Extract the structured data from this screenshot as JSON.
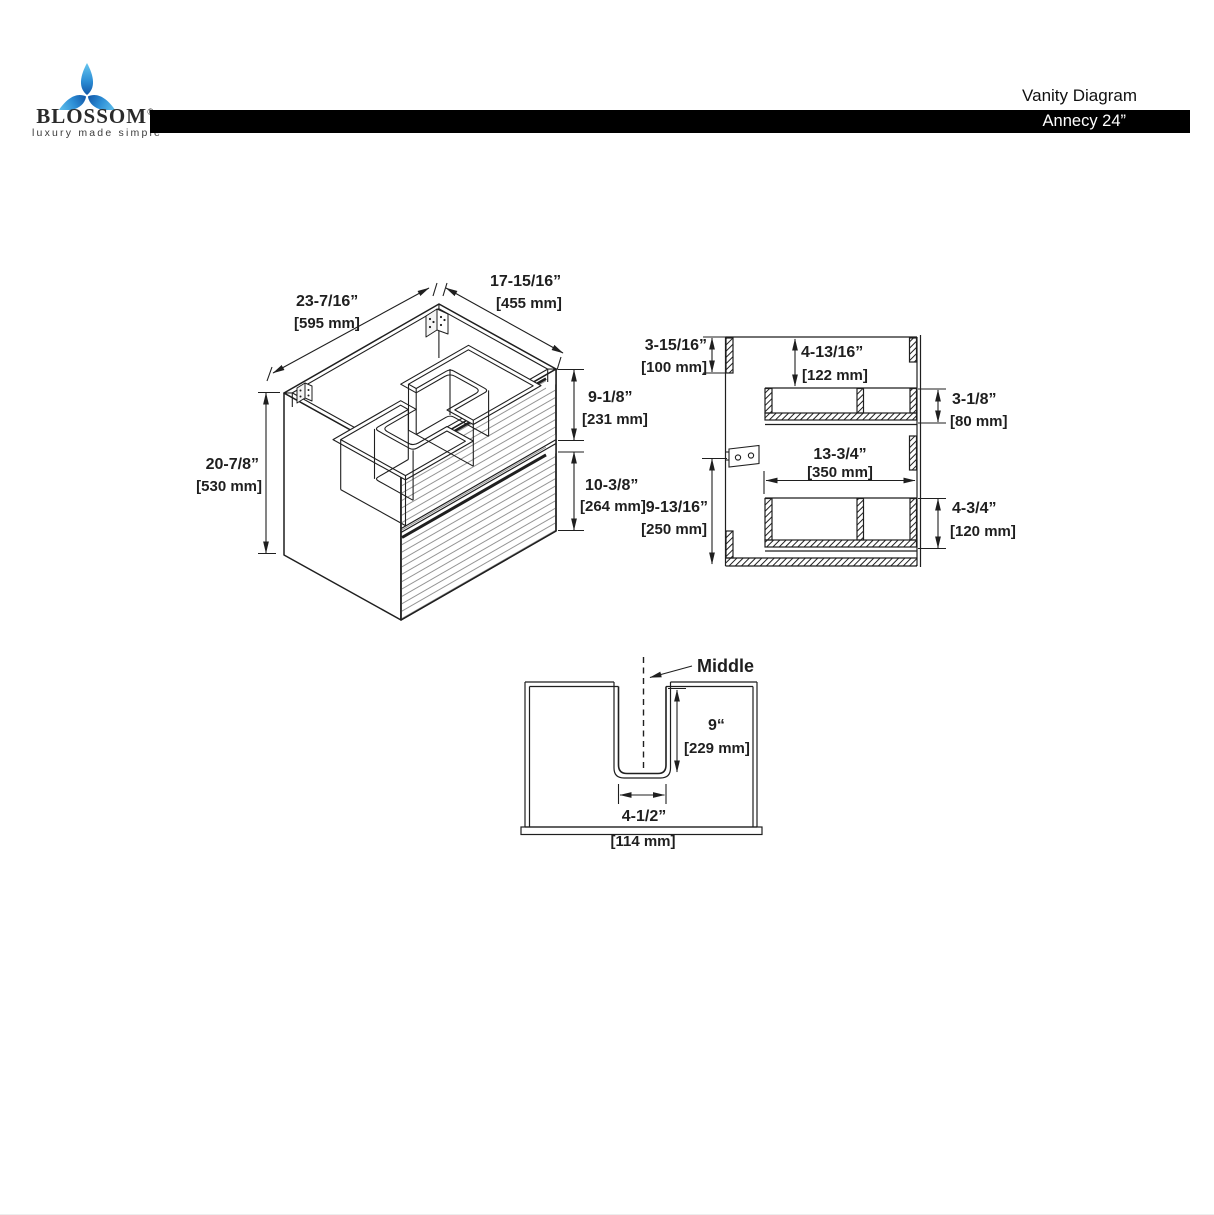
{
  "header": {
    "brand": {
      "name": "BLOSSOM",
      "reg": "®",
      "tagline": "luxury made simple"
    },
    "doc_title": "Vanity Diagram",
    "model": "Annecy 24”"
  },
  "iso": {
    "width_in": "23-7/16”",
    "width_mm": "[595 mm]",
    "depth_in": "17-15/16”",
    "depth_mm": "[455 mm]",
    "height_in": "20-7/8”",
    "height_mm": "[530 mm]",
    "top_drawer_in": "9-1/8”",
    "top_drawer_mm": "[231 mm]",
    "bottom_drawer_in": "10-3/8”",
    "bottom_drawer_mm": "[264 mm]"
  },
  "section": {
    "rail_in": "3-15/16”",
    "rail_mm": "[100 mm]",
    "clearance_in": "4-13/16”",
    "clearance_mm": "[122 mm]",
    "upper_box_in": "3-1/8”",
    "upper_box_mm": "[80 mm]",
    "box_width_in": "13-3/4”",
    "box_width_mm": "[350 mm]",
    "lower_span_in": "9-13/16”",
    "lower_span_mm": "[250 mm]",
    "lower_box_in": "4-3/4”",
    "lower_box_mm": "[120 mm]"
  },
  "cutout": {
    "middle": "Middle",
    "depth_in": "9“",
    "depth_mm": "[229 mm]",
    "width_in": "4-1/2”",
    "width_mm": "[114 mm]"
  },
  "colors": {
    "line": "#1f1f1f",
    "bar_bg": "#000000",
    "bar_text": "#ffffff",
    "stripe": "#8a8a8a",
    "logo_blue_dark": "#1257a8",
    "logo_blue_light": "#66c6ef"
  }
}
